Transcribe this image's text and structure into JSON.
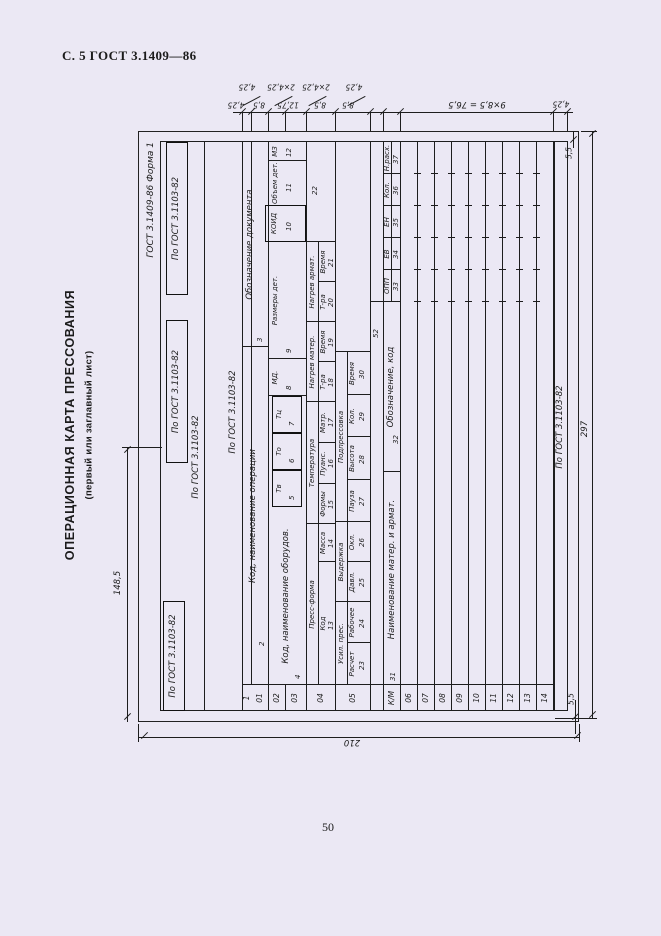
{
  "page": {
    "header": "С. 5 ГОСТ 3.1409—86",
    "page_number": "50",
    "side_title": "ОПЕРАЦИОННАЯ КАРТА ПРЕССОВАНИЯ",
    "side_subtitle": "(первый или заглавный лист)"
  },
  "form": {
    "designation": "ГОСТ 3.1409-86   Форма 1",
    "gost_ref": "По ГОСТ 3.1103-82",
    "left_col": {
      "seq": "1",
      "r01": "01",
      "r02": "02",
      "r03": "03",
      "r04": "04",
      "r05": "05",
      "km": "К/М",
      "data_rows": [
        "06",
        "07",
        "08",
        "09",
        "10",
        "11",
        "12",
        "13",
        "14"
      ]
    },
    "row01": {
      "f2": {
        "num": "2",
        "label": "Код, наименование операции"
      },
      "f3": {
        "num": "3",
        "label": "Обозначение документа"
      }
    },
    "row0203": {
      "f4": {
        "num": "4",
        "label": "Код, наименование оборудов."
      },
      "f5": {
        "num": "5",
        "label": "Тв"
      },
      "f6": {
        "num": "6",
        "label": "То"
      },
      "f7": {
        "num": "7",
        "label": "Тц"
      },
      "f8": {
        "num": "8",
        "label": "МД."
      },
      "f9": {
        "num": "9",
        "label": "Размеры дет."
      },
      "f10": {
        "num": "10",
        "label": "КОИД"
      },
      "f11": {
        "num": "11",
        "label": "Объем дет."
      },
      "f12": {
        "num": "12",
        "label": "МЗ"
      }
    },
    "row04": {
      "group1": "Пресс-форма",
      "f13": {
        "num": "13",
        "label": "Код"
      },
      "f14": {
        "num": "14",
        "label": "Масса"
      },
      "group2": "Температура",
      "f15": {
        "num": "15",
        "label": "Формы"
      },
      "f16": {
        "num": "16",
        "label": "Пуанс."
      },
      "f17": {
        "num": "17",
        "label": "Матр."
      },
      "group3": "Нагрев матер.",
      "f18": {
        "num": "18",
        "label": "Т-ра"
      },
      "f19": {
        "num": "19",
        "label": "Время"
      },
      "group4": "Нагрев армат.",
      "f20": {
        "num": "20",
        "label": "Т-ра"
      },
      "f21": {
        "num": "21",
        "label": "Время"
      },
      "f22": {
        "num": "22"
      }
    },
    "row05": {
      "group1": "Усил. прес.",
      "f23": {
        "num": "23",
        "label": "Расчет"
      },
      "f24": {
        "num": "24",
        "label": "Рабочее"
      },
      "group2": "Выдержка",
      "f25": {
        "num": "25",
        "label": "Давл."
      },
      "f26": {
        "num": "26",
        "label": "Окл."
      },
      "group3": "Подпрессовка",
      "f27": {
        "num": "27",
        "label": "Пауза"
      },
      "f28": {
        "num": "28",
        "label": "Высота"
      },
      "f29": {
        "num": "29",
        "label": "Кол."
      },
      "f30": {
        "num": "30",
        "label": "Время"
      },
      "f52": {
        "num": "52"
      }
    },
    "rowkm": {
      "f31": {
        "num": "31",
        "label": "Наименование матер.  и  армат."
      },
      "f32": {
        "num": "32",
        "label": "Обозначение, код"
      },
      "f33": {
        "num": "33",
        "label": "ОПП"
      },
      "f34": {
        "num": "34",
        "label": "ЕВ"
      },
      "f35": {
        "num": "35",
        "label": "ЕН"
      },
      "f36": {
        "num": "36",
        "label": "Кол."
      },
      "f37": {
        "num": "37",
        "label": "Н.расх."
      }
    }
  },
  "dimensions": {
    "top_slant": [
      "4,25",
      "2×4,25",
      "2×4,25",
      "4,25"
    ],
    "top_inline": [
      "4,25",
      "8,5",
      "12,75",
      "8,5",
      "8,5"
    ],
    "data_rows_dim": "9×8,5 = 76,5",
    "footer_dim": "4,25",
    "margin_dim": "5,5",
    "width_dim": "297",
    "height_dim": "210",
    "half_dim": "148,5"
  }
}
